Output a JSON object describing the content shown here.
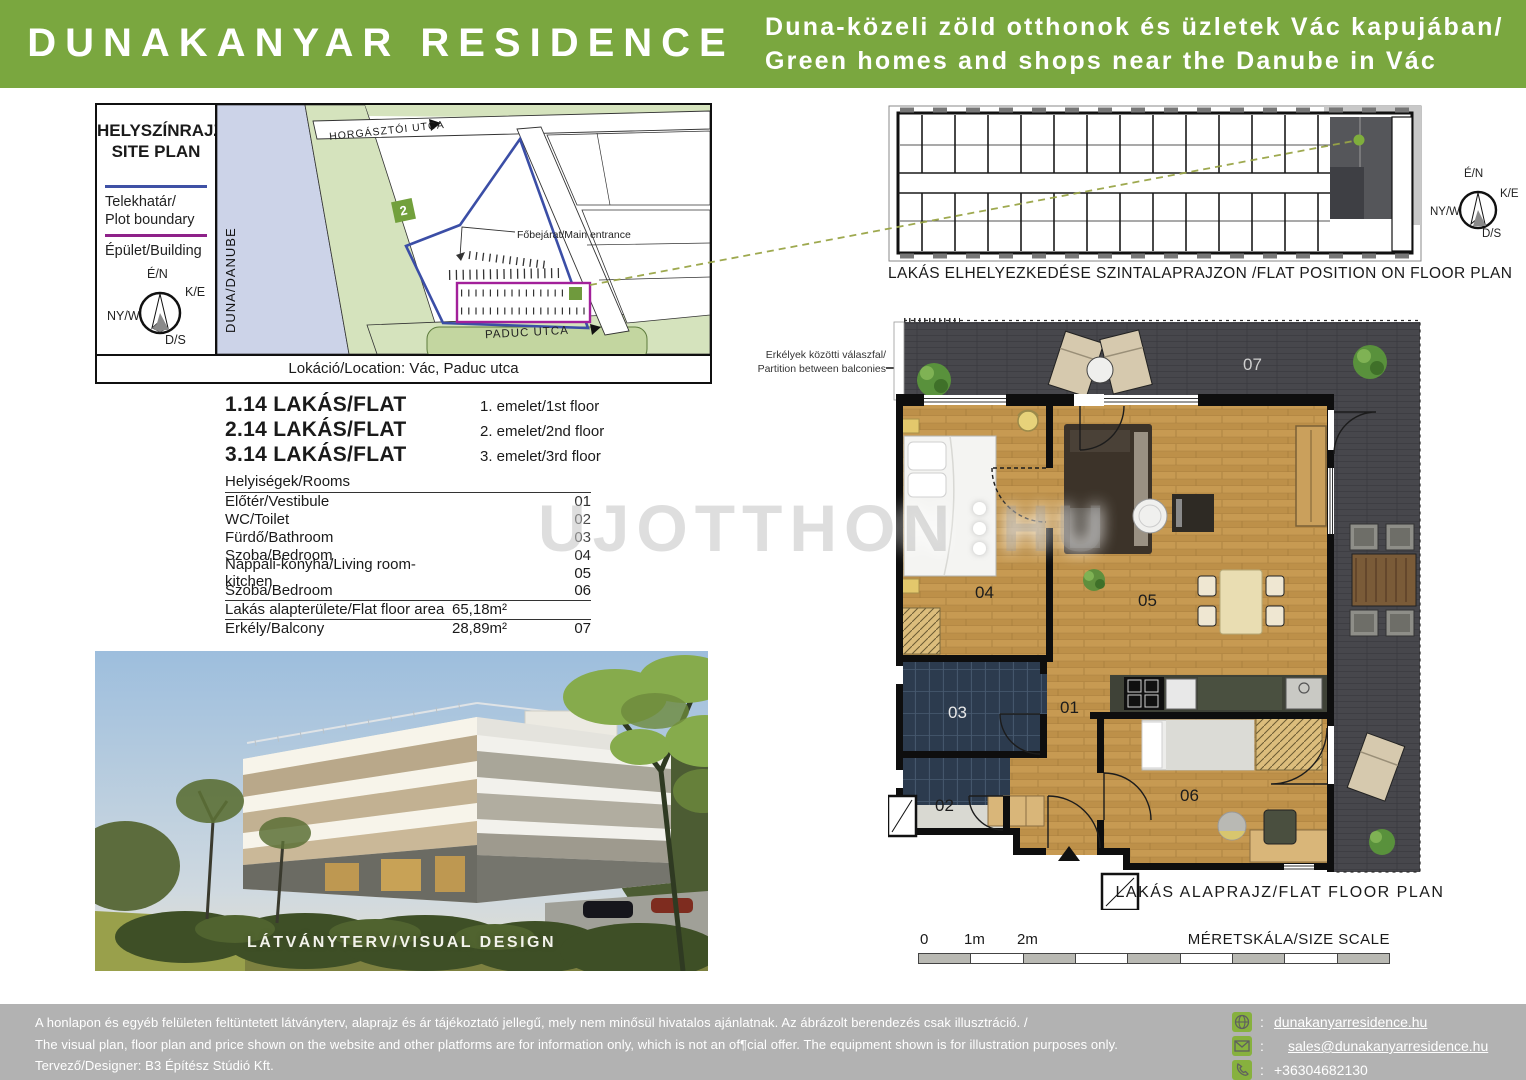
{
  "header": {
    "title": "DUNAKANYAR RESIDENCE",
    "tagline_hu": "Duna-közeli zöld otthonok és üzletek Vác kapujában/",
    "tagline_en": "Green homes and shops near the Danube in Vác"
  },
  "site_plan": {
    "heading_line1": "HELYSZÍNRAJZ/",
    "heading_line2": "SITE PLAN",
    "legend": [
      {
        "label_line1": "Telekhatár/",
        "label_line2": "Plot boundary",
        "color": "#3f51a5"
      },
      {
        "label_line1": "Épület/Building",
        "label_line2": "",
        "color": "#8e2189"
      }
    ],
    "compass": {
      "n": "É/N",
      "e": "K/E",
      "w": "NY/W",
      "s": "D/S"
    },
    "river_label": "DUNA/DANUBE",
    "street_top": "HORGÁSZTÓI UTCA",
    "street_bottom": "PADUC UTCA",
    "route_badge": "2",
    "entrance_label": "Főbejárat/Main entrance",
    "location": "Lokáció/Location: Vác, Paduc utca"
  },
  "flats": [
    {
      "name": "1.14 LAKÁS/FLAT",
      "floor": "1. emelet/1st floor"
    },
    {
      "name": "2.14 LAKÁS/FLAT",
      "floor": "2. emelet/2nd floor"
    },
    {
      "name": "3.14 LAKÁS/FLAT",
      "floor": "3. emelet/3rd floor"
    }
  ],
  "rooms": {
    "header": "Helyiségek/Rooms",
    "items": [
      {
        "name": "Előtér/Vestibule",
        "num": "01"
      },
      {
        "name": "WC/Toilet",
        "num": "02"
      },
      {
        "name": "Fürdő/Bathroom",
        "num": "03"
      },
      {
        "name": "Szoba/Bedroom",
        "num": "04"
      },
      {
        "name": "Nappali-konyha/Living  room-kitchen",
        "num": "05"
      },
      {
        "name": "Szoba/Bedroom",
        "num": "06"
      }
    ],
    "area_rows": [
      {
        "name": "Lakás alapterülete/Flat floor area",
        "value": "65,18m²",
        "num": ""
      },
      {
        "name": "Erkély/Balcony",
        "value": "28,89m²",
        "num": "07"
      }
    ]
  },
  "photo": {
    "caption": "LÁTVÁNYTERV/VISUAL DESIGN"
  },
  "position_plan": {
    "caption": "LAKÁS ELHELYEZKEDÉSE SZINTALAPRAJZON /FLAT POSITION ON FLOOR PLAN"
  },
  "floor_plan": {
    "caption": "LAKÁS ALAPRAJZ/FLAT FLOOR PLAN",
    "partition_line1": "Erkélyek közötti válaszfal/",
    "partition_line2": "Partition between balconies",
    "labels": {
      "r01": "01",
      "r02": "02",
      "r03": "03",
      "r04": "04",
      "r05": "05",
      "r06": "06",
      "r07": "07"
    }
  },
  "scale_bar": {
    "t0": "0",
    "t1": "1m",
    "t2": "2m",
    "label": "MÉRETSKÁLA/SIZE SCALE"
  },
  "watermark": {
    "text": "UJOTTHON",
    "suffix": "HU"
  },
  "footer": {
    "line_hu": "A honlapon és egyéb felületen feltüntetett látványterv,  alaprajz és ár tájékoztató jellegű, mely nem minősül hivatalos ajánlatnak. Az ábrázolt berendezés csak illusztráció. /",
    "line_en": "The visual plan, floor plan and price shown on the website and other platforms are for information only, which is not an of¶cial offer. The equipment shown is for illustration purposes only.",
    "designer": "Tervező/Designer:  B3 Építész Stúdió Kft.",
    "contacts": [
      {
        "icon": "globe",
        "value": "dunakanyarresidence.hu"
      },
      {
        "icon": "email",
        "value": "sales@dunakanyarresidence.hu"
      },
      {
        "icon": "phone",
        "value": "+36304682130"
      }
    ],
    "colors": {
      "accent_green": "#7aa73f",
      "icon_green": "#87b13e",
      "footer_gray": "#b2b2b2"
    }
  }
}
